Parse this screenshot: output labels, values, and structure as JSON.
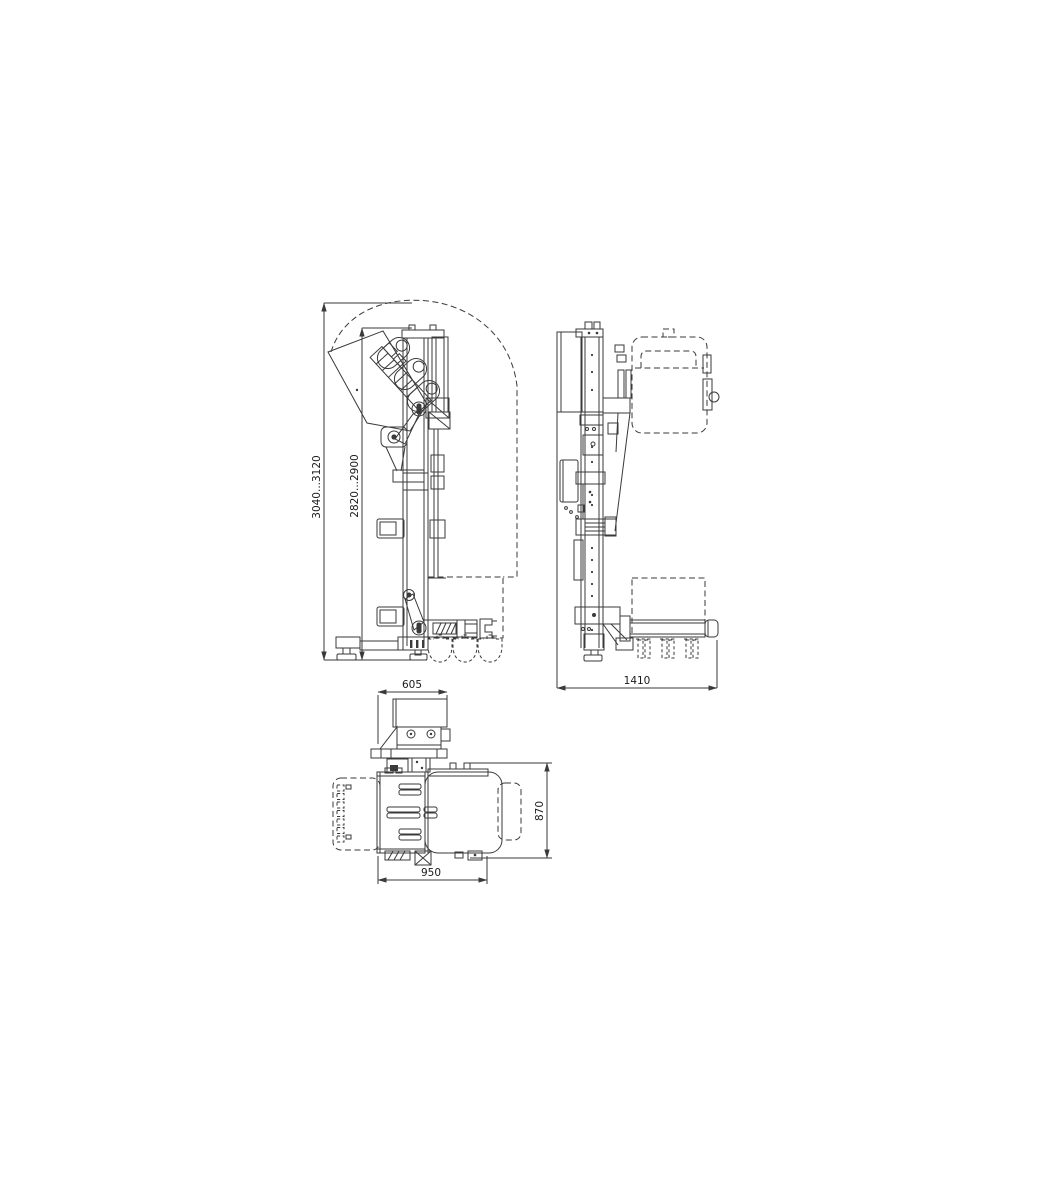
{
  "drawing": {
    "background_color": "#ffffff",
    "line_color": "#3a3a3a",
    "text_color": "#1a1a1a",
    "dims": {
      "front_overall_height": "3040...3120",
      "front_mast_height": "2820...2900",
      "side_overall_width": "1410",
      "top_head_width": "605",
      "top_body_depth": "870",
      "top_body_width": "950"
    }
  }
}
